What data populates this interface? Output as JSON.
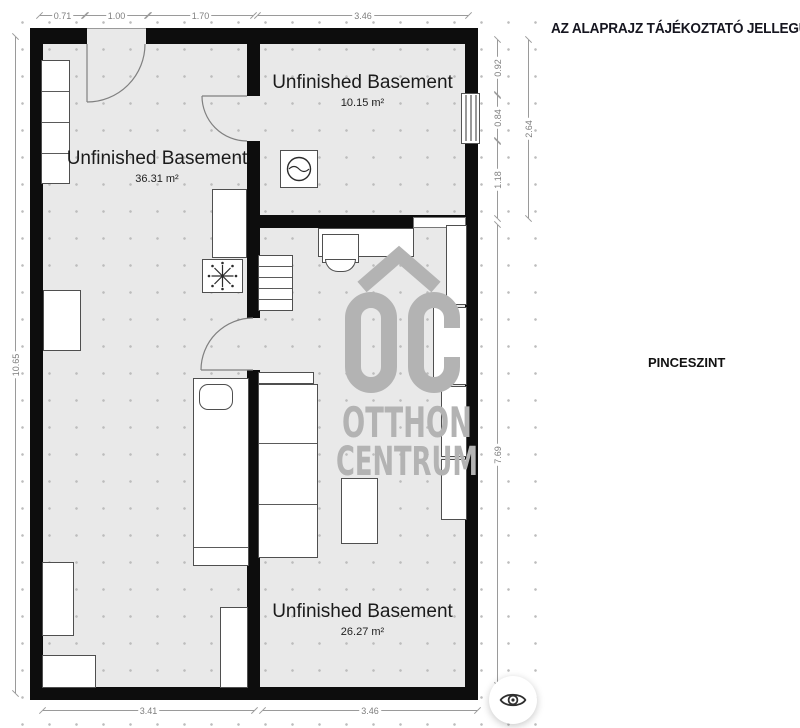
{
  "right_panel": {
    "disclaimer": "AZ ALAPRAJZ TÁJÉKOZTATÓ JELLEGŰ!",
    "floor_label": "PINCESZINT"
  },
  "rooms": [
    {
      "name": "Unfinished Basement",
      "area": "36.31 m²"
    },
    {
      "name": "Unfinished Basement",
      "area": "10.15 m²"
    },
    {
      "name": "Unfinished Basement",
      "area": "26.27 m²"
    }
  ],
  "dimensions": {
    "top": [
      "0.71",
      "1.00",
      "1.70",
      "3.46"
    ],
    "bottom": [
      "3.41",
      "3.46"
    ],
    "left": [
      "10.65"
    ],
    "right_upper": [
      "0.92",
      "0.84",
      "1.18"
    ],
    "right_outer": [
      "2.64"
    ],
    "right_lower": [
      "7.69"
    ]
  },
  "watermark": {
    "monogram": "OC",
    "line1": "OTTHON",
    "line2": "CENTRUM"
  },
  "icons": {
    "preview_button": "eye-icon",
    "floor_symbol": "snowflake-icon",
    "appliance_symbol": "washing-machine-drum-icon"
  },
  "colors": {
    "wall": "#0d0d0d",
    "floor": "#e9e9e9",
    "watermark": "#b3b3b3",
    "dimension": "#9a9a9a",
    "label_text": "#1b1b1b"
  }
}
